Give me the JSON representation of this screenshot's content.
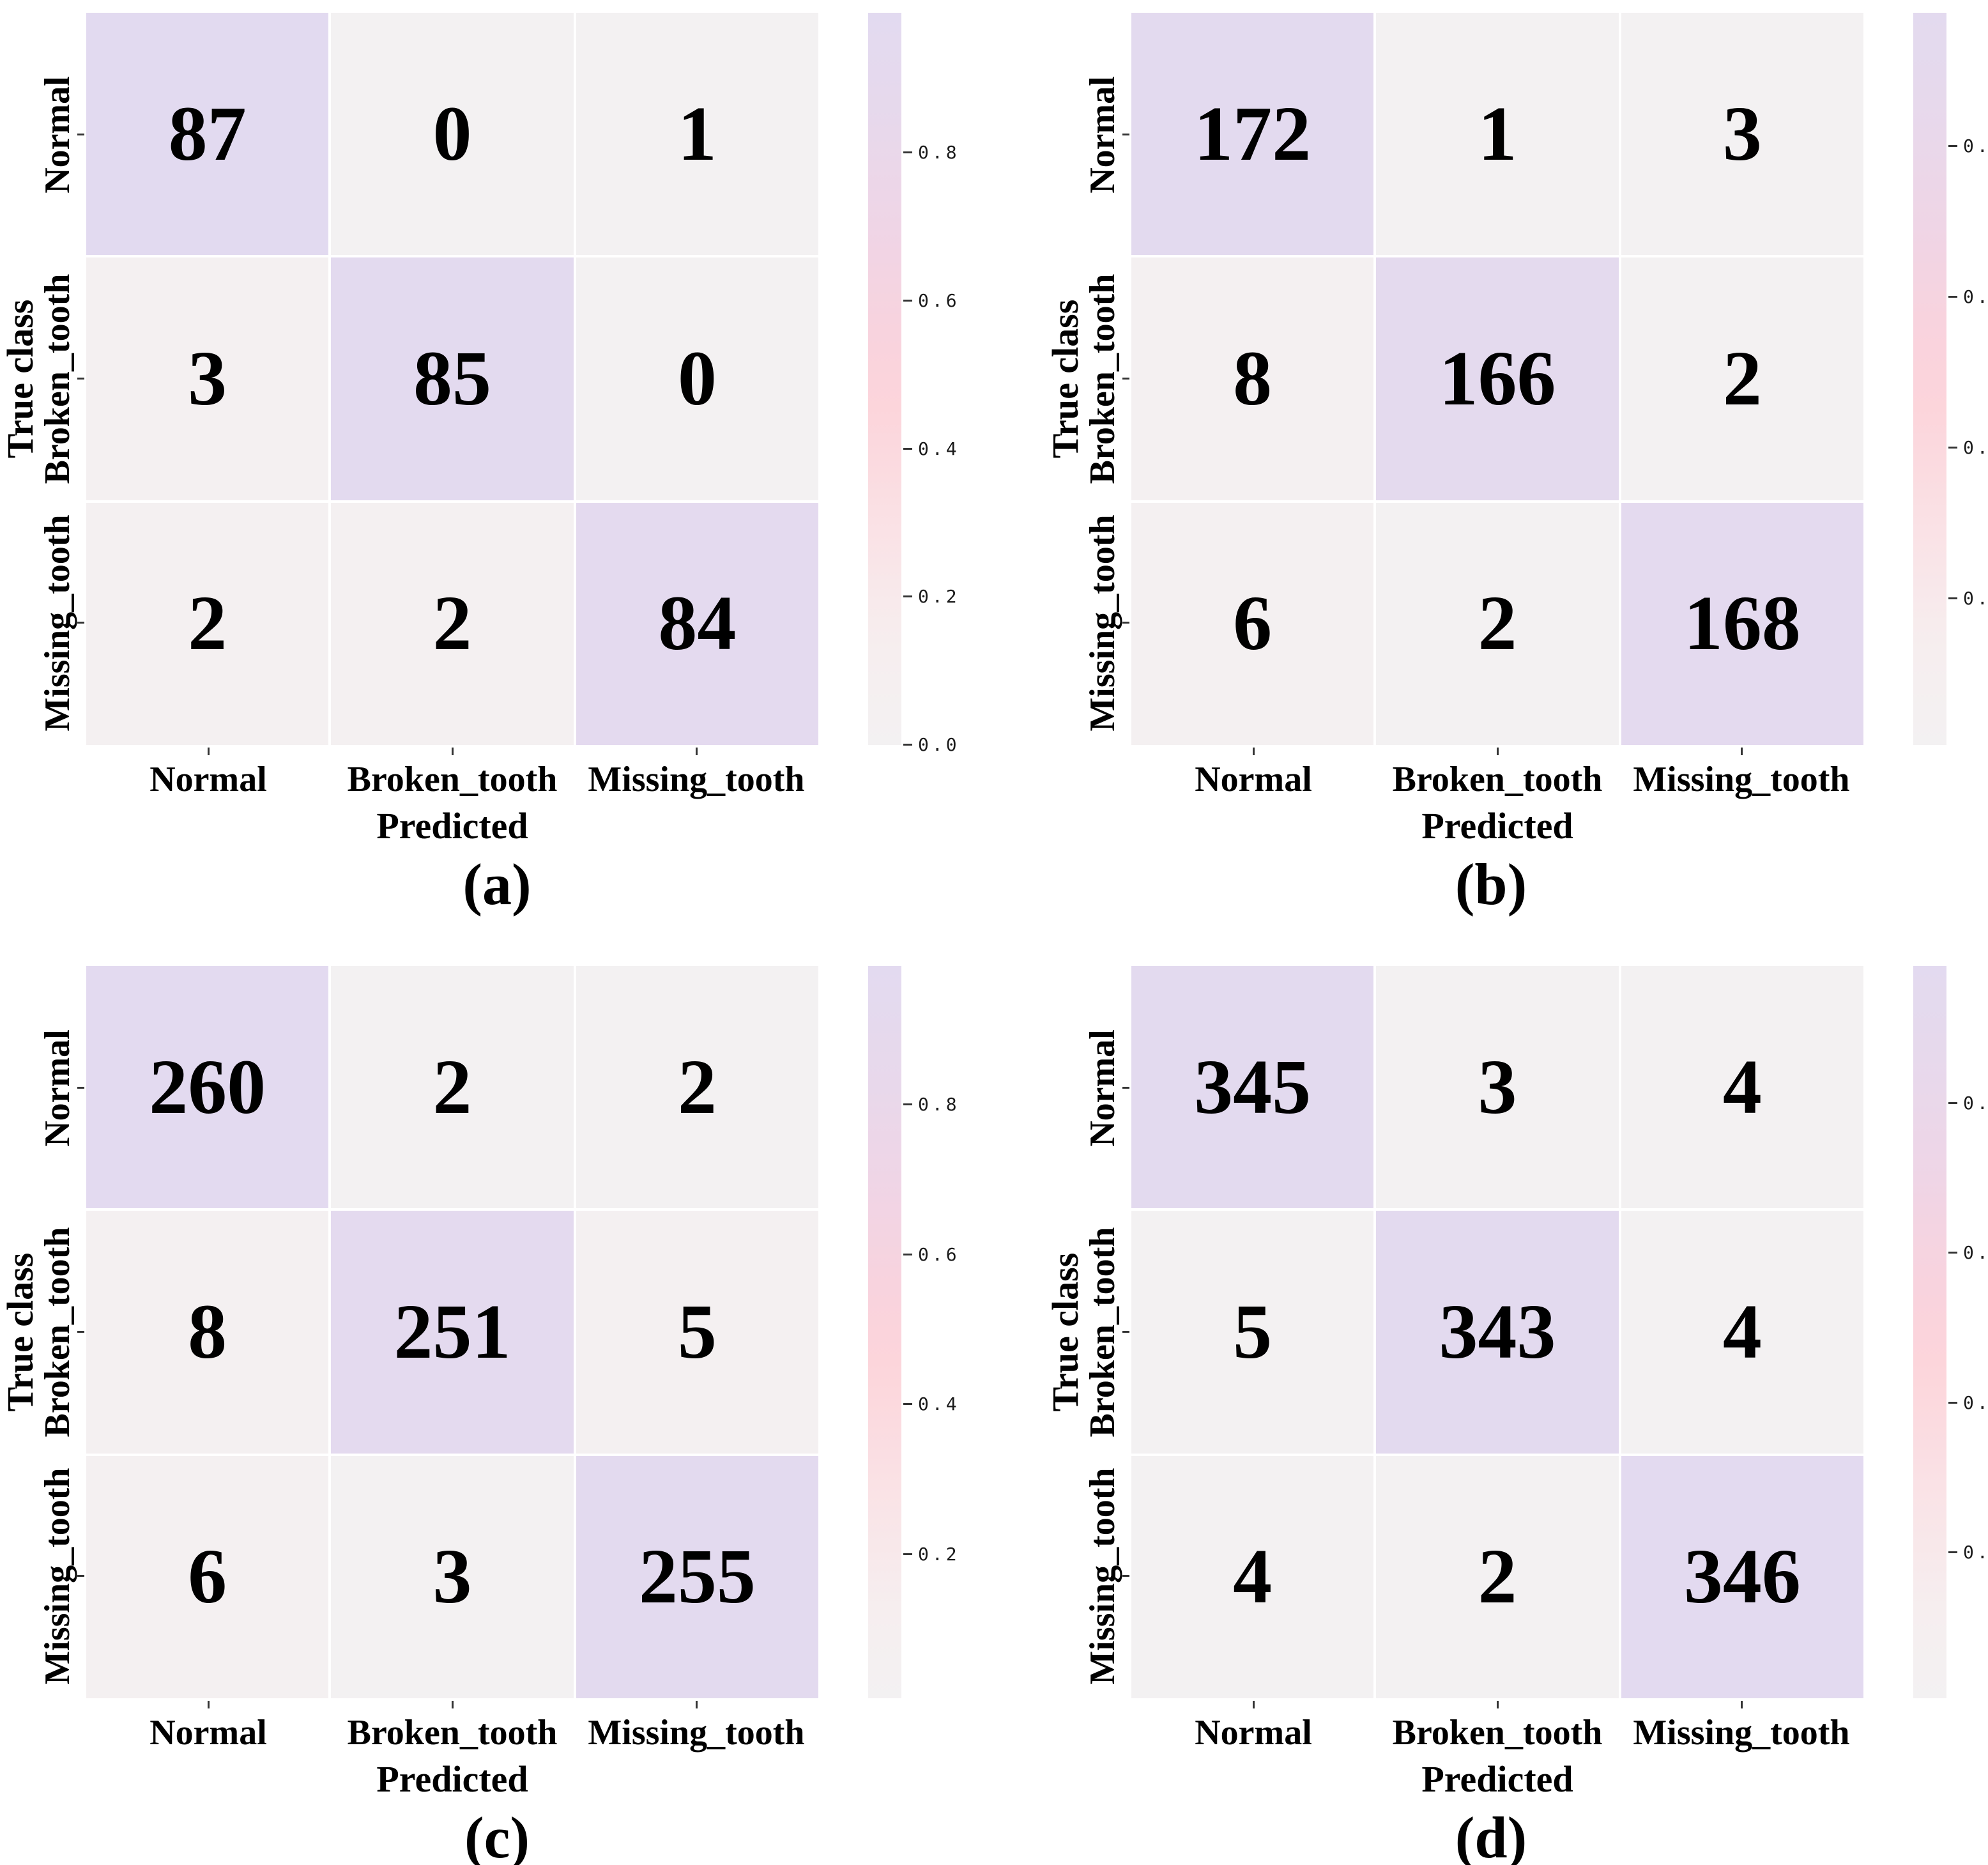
{
  "figure": {
    "background": "#ffffff",
    "kind": "confusion-matrix-grid"
  },
  "colors": {
    "cell_text": "#000000",
    "label_text": "#000000",
    "tick_text": "#1a1a1a",
    "tick_mark": "#333333",
    "cell_gap": "#ffffff",
    "colormap_stops": [
      [
        0.0,
        "#f3f1f2"
      ],
      [
        0.15,
        "#f7edee"
      ],
      [
        0.3,
        "#fae1e5"
      ],
      [
        0.45,
        "#fcd5db"
      ],
      [
        0.55,
        "#f9d3dd"
      ],
      [
        0.7,
        "#efd5e6"
      ],
      [
        0.85,
        "#e7d9ec"
      ],
      [
        1.0,
        "#e2daf0"
      ]
    ]
  },
  "chart_data": [
    {
      "type": "heatmap",
      "panel": "a",
      "caption": "(a)",
      "xlabel": "Predicted",
      "ylabel": "True class",
      "x_categories": [
        "Normal",
        "Broken_tooth",
        "Missing_tooth"
      ],
      "y_categories": [
        "Normal",
        "Broken_tooth",
        "Missing_tooth"
      ],
      "values": [
        [
          87,
          0,
          1
        ],
        [
          3,
          85,
          0
        ],
        [
          2,
          2,
          84
        ]
      ],
      "normalization": "row",
      "legend_position": "right",
      "grid": false,
      "colorbar": {
        "ticks": [
          "0.8",
          "0.6",
          "0.4",
          "0.2",
          "0.0"
        ],
        "vmin": 0.0,
        "vmax": 0.989
      }
    },
    {
      "type": "heatmap",
      "panel": "b",
      "caption": "(b)",
      "xlabel": "Predicted",
      "ylabel": "True class",
      "x_categories": [
        "Normal",
        "Broken_tooth",
        "Missing_tooth"
      ],
      "y_categories": [
        "Normal",
        "Broken_tooth",
        "Missing_tooth"
      ],
      "values": [
        [
          172,
          1,
          3
        ],
        [
          8,
          166,
          2
        ],
        [
          6,
          2,
          168
        ]
      ],
      "normalization": "row",
      "legend_position": "right",
      "grid": false,
      "colorbar": {
        "ticks": [
          "0.8",
          "0.6",
          "0.4",
          "0.2"
        ],
        "vmin": 0.006,
        "vmax": 0.977
      }
    },
    {
      "type": "heatmap",
      "panel": "c",
      "caption": "(c)",
      "xlabel": "Predicted",
      "ylabel": "True class",
      "x_categories": [
        "Normal",
        "Broken_tooth",
        "Missing_tooth"
      ],
      "y_categories": [
        "Normal",
        "Broken_tooth",
        "Missing_tooth"
      ],
      "values": [
        [
          260,
          2,
          2
        ],
        [
          8,
          251,
          5
        ],
        [
          6,
          3,
          255
        ]
      ],
      "normalization": "row",
      "legend_position": "right",
      "grid": false,
      "colorbar": {
        "ticks": [
          "0.8",
          "0.6",
          "0.4",
          "0.2"
        ],
        "vmin": 0.008,
        "vmax": 0.985
      }
    },
    {
      "type": "heatmap",
      "panel": "d",
      "caption": "(d)",
      "xlabel": "Predicted",
      "ylabel": "True class",
      "x_categories": [
        "Normal",
        "Broken_tooth",
        "Missing_tooth"
      ],
      "y_categories": [
        "Normal",
        "Broken_tooth",
        "Missing_tooth"
      ],
      "values": [
        [
          345,
          3,
          4
        ],
        [
          5,
          343,
          4
        ],
        [
          4,
          2,
          346
        ]
      ],
      "normalization": "row",
      "legend_position": "right",
      "grid": false,
      "colorbar": {
        "ticks": [
          "0.8",
          "0.6",
          "0.4",
          "0.2"
        ],
        "vmin": 0.006,
        "vmax": 0.983
      }
    }
  ]
}
